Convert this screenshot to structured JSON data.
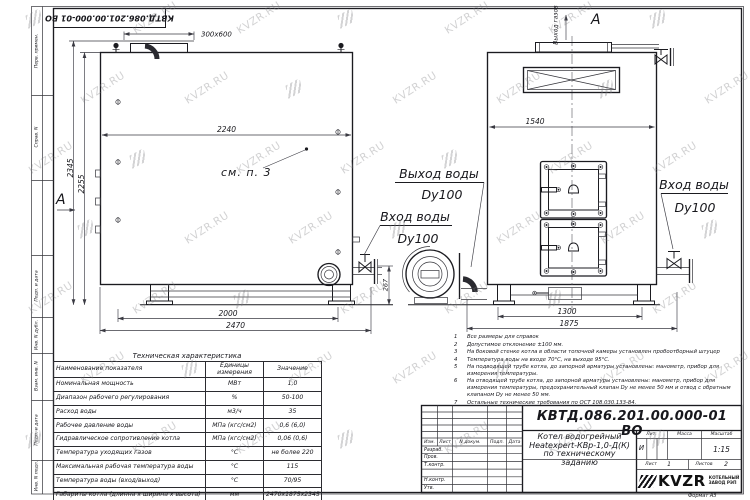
{
  "sheet": {
    "stamp_rotated": "КВТД.086.201.00.000-01 ВО",
    "margin_labels": [
      "Перв. примен.",
      "Справ. N",
      "Подп. и дата",
      "Инв. N дубл.",
      "Взам. инв. N",
      "Подп. и дата",
      "Инв. N подл."
    ]
  },
  "watermark": {
    "text": "KVZR.RU"
  },
  "side_view": {
    "dim_top_width": "2240",
    "dim_height_total": "2345",
    "dim_height_body": "2255",
    "dim_base_inner": "2000",
    "dim_base_outer": "2470",
    "dim_chimney": "300x600",
    "dim_pipe_height": "267",
    "callout_note": "см. п. 3",
    "section_label": "А"
  },
  "front_view": {
    "dim_width": "1540",
    "dim_base_inner": "1300",
    "dim_base_outer": "1875",
    "label_gas_outlet": "Выход газов",
    "section_label": "А",
    "label_water_outlet": "Выход воды",
    "label_water_outlet_dn": "Dy100",
    "label_water_inlet_mid": "Вход воды",
    "label_water_inlet_mid_dn": "Dy100",
    "label_water_inlet_right": "Вход воды",
    "label_water_inlet_right_dn": "Dy100"
  },
  "notes": [
    {
      "num": "1",
      "text": "Все размеры для справок"
    },
    {
      "num": "2",
      "text": "Допустимое отклонение ±100 мм."
    },
    {
      "num": "3",
      "text": "На боковой стенке котла в области топочной камеры установлен пробоотборный штуцер"
    },
    {
      "num": "4",
      "text": "Температура воды на входе 70°С, на выходе 95°С."
    },
    {
      "num": "5",
      "text": "На подводящей трубе котла, до запорной арматуры установлены: манометр, прибор для измерения температуры."
    },
    {
      "num": "6",
      "text": "На отводящей трубе котла, до запорной арматуры установлены: манометр, прибор для измерения температуры, предохранительный клапан Dу не менее 50 мм и отвод с обратным клапаном Dу не менее 50 мм."
    },
    {
      "num": "7",
      "text": "Остальные технические требования по ОСТ 108.030.133-84."
    }
  ],
  "tech_table": {
    "title": "Техническая характеристика",
    "col_name": "Наименование показателя",
    "col_units": "Единицы измерения",
    "col_value": "Значение",
    "rows": [
      {
        "name": "Номинальная мощность",
        "units": "МВт",
        "value": "1,0"
      },
      {
        "name": "Диапазон рабочего регулирования",
        "units": "%",
        "value": "50-100"
      },
      {
        "name": "Расход воды",
        "units": "м3/ч",
        "value": "35"
      },
      {
        "name": "Рабочее давление воды",
        "units": "МПа (кгс/см2)",
        "value": "0,6 (6,0)"
      },
      {
        "name": "Гидравлическое сопротивление котла",
        "units": "МПа (кгс/см2)",
        "value": "0,06 (0,6)"
      },
      {
        "name": "Температура уходящих газов",
        "units": "°С",
        "value": "не более 220"
      },
      {
        "name": "Максимальная рабочая температура воды",
        "units": "°С",
        "value": "115"
      },
      {
        "name": "Температура воды (вход/выход)",
        "units": "°С",
        "value": "70/95"
      },
      {
        "name": "Габариты котла (длинна х ширина х высота)",
        "units": "мм",
        "value": "2470х1875х2345"
      }
    ]
  },
  "title_block": {
    "doc_number": "КВТД.086.201.00.000-01 ВО",
    "title_line1": "Котел водогрейный",
    "title_line2": "Heatexpert-КВр-1,0-Д(К)",
    "title_line3": "по техническому заданию",
    "col_izm": "Изм.",
    "col_list": "Лист",
    "col_doc": "N докум.",
    "col_podp": "Подп.",
    "col_data": "Дата",
    "row_razrab": "Разраб.",
    "row_prov": "Пров.",
    "row_tkontr": "Т.контр.",
    "row_nkontr": "Н.контр.",
    "row_utv": "Утв.",
    "lit_header": "Лит.",
    "mass_header": "Масса",
    "scale_header": "Масштаб",
    "lit_value": "И",
    "scale_value": "1:15",
    "sheet_label": "Лист",
    "sheet_value": "1",
    "sheets_label": "Листов",
    "sheets_value": "2",
    "logo_text": "KVZR",
    "logo_sub1": "КОТЕЛЬНЫЙ",
    "logo_sub2": "ЗАВОД РЭП",
    "format_label": "Формат А3"
  }
}
